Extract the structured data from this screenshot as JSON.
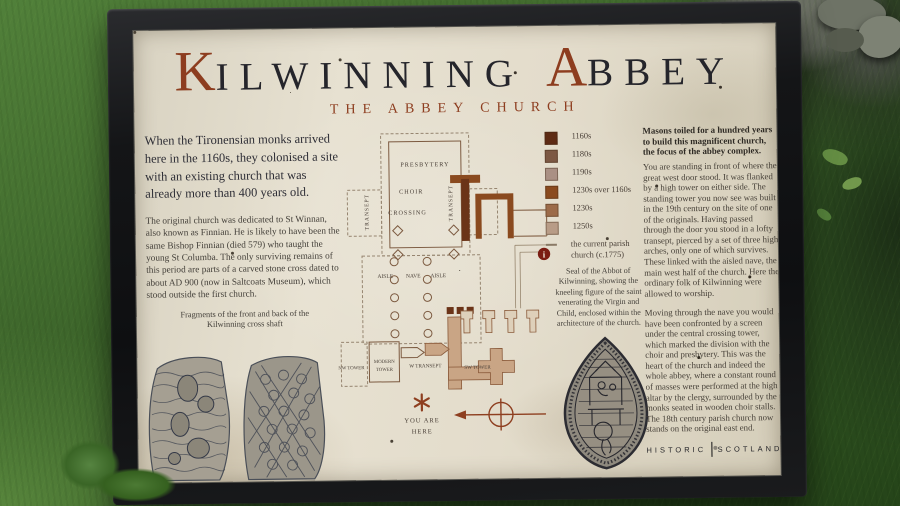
{
  "colors": {
    "rust_accent": "#8d3d1f",
    "title_ink": "#25252b",
    "body_text": "#44403a",
    "board_background": "#e4decf",
    "frame": "#141517",
    "info_icon_red": "#7a1c12",
    "plan_tan_fill": "#c9a585",
    "plan_brown_dark": "#6b3418",
    "plan_brown_mid": "#8a4a1f"
  },
  "title": {
    "initial_1": "K",
    "word_1": "ILWINNING",
    "initial_2": "A",
    "word_2": "BBEY",
    "subtitle": "THE ABBEY CHURCH"
  },
  "left_column": {
    "intro": "When the Tironensian monks arrived here in the 1160s, they colonised a site with an existing church that was already more than 400 years old.",
    "body": "The original church was dedicated to St Winnan, also known as Finnian.  He is likely to have been the same Bishop Finnian (died 579) who taught the young St Columba.  The only surviving remains of this period are parts of a carved stone cross dated to about AD 900 (now in Saltcoats Museum), which stood outside the first church.",
    "stones_caption": "Fragments of the front and back of the Kilwinning cross shaft"
  },
  "plan": {
    "labels": {
      "presbytery": "PRESBYTERY",
      "choir": "CHOIR",
      "crossing": "CROSSING",
      "transept_left": "TRANSEPT",
      "transept_right": "TRANSEPT",
      "aisle_left": "AISLE",
      "nave": "NAVE",
      "aisle_right": "AISLE",
      "nw_tower": "NW TOWER",
      "modern_tower_line1": "MODERN",
      "modern_tower_line2": "TOWER",
      "w_transept": "W TRANSEPT",
      "sw_tower": "SW TOWER"
    },
    "info_icon": "i",
    "marker_icon": "asterisk",
    "compass_icon": "compass-west-arrow",
    "you_are_here_line1": "YOU ARE",
    "you_are_here_line2": "HERE"
  },
  "legend": {
    "items": [
      {
        "label": "1160s",
        "color": "#5e2b14",
        "symbol": "square"
      },
      {
        "label": "1180s",
        "color": "#7c5843",
        "symbol": "square"
      },
      {
        "label": "1190s",
        "color": "#aa9084",
        "symbol": "square"
      },
      {
        "label": "1230s over 1160s",
        "color": "#8a4a1e",
        "symbol": "square"
      },
      {
        "label": "1230s",
        "color": "#9c6b49",
        "symbol": "square"
      },
      {
        "label": "1250s",
        "color": "#b89c87",
        "symbol": "square"
      },
      {
        "label": "the current parish church (c.1775)",
        "color": "#8a7a66",
        "symbol": "line"
      }
    ]
  },
  "seal_caption": "Seal of the Abbot of Kilwinning, showing the kneeling figure of the saint venerating the Virgin and Child, enclosed within the architecture of the church.",
  "right_column": {
    "lead": "Masons toiled for a hundred years to build this magnificent church, the focus of the abbey complex.",
    "para_1": "You are standing in front of where the great west door stood. It was flanked by a high tower on either side. The standing tower you now see was built in the 19th century on the site of one of the originals. Having passed through the door you stood in a lofty transept, pierced by a set of three high arches, only one of which survives. These linked with the aisled nave, the main west half of the church. Here the ordinary folk of Kilwinning were allowed to worship.",
    "para_2": "Moving through the nave you would have been confronted by a screen under the central crossing tower, which marked the division with the choir and presbytery. This was the heart of the church and indeed the whole abbey, where a constant round of masses were performed at the high altar by the clergy, surrounded by the monks seated in wooden choir stalls. The 18th century parish church now stands on the original east end.",
    "logo_left": "HISTORIC",
    "logo_right": "SCOTLAND"
  }
}
